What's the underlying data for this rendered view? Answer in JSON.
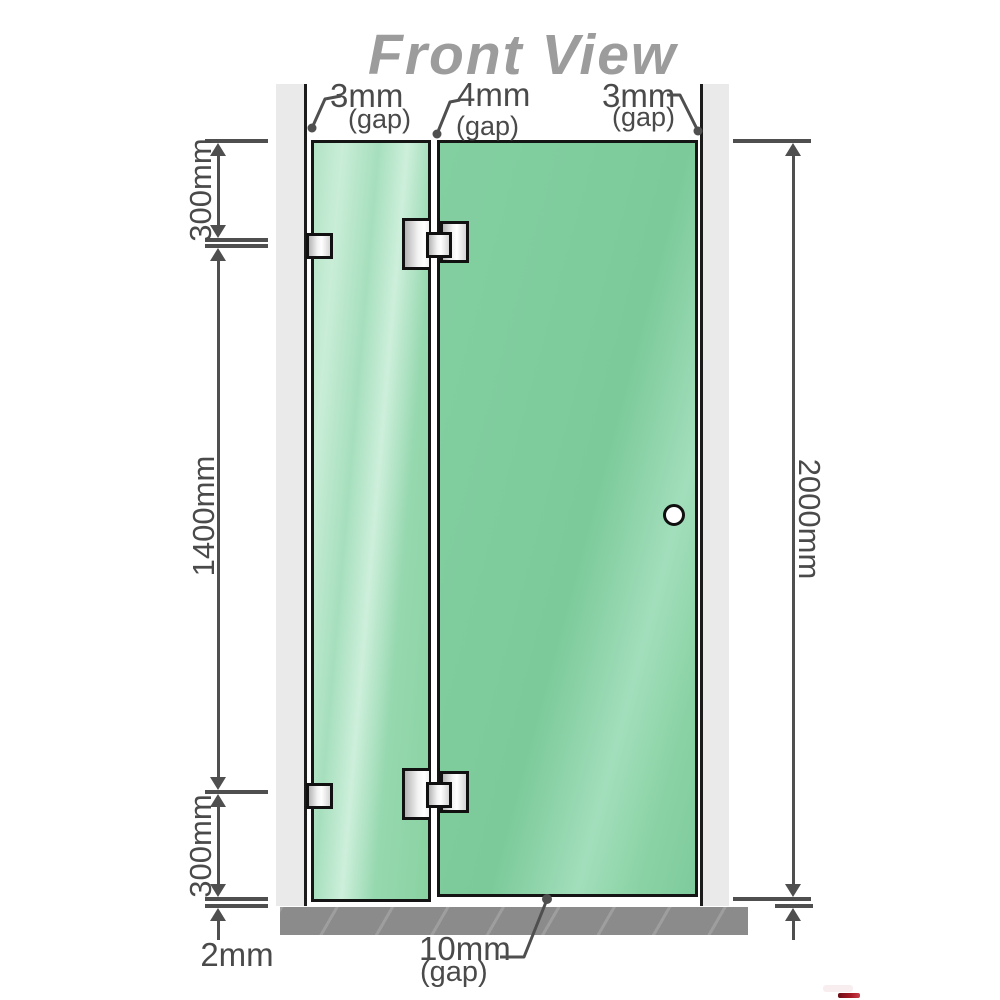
{
  "title": "Front View",
  "dimension_labels": {
    "top_left_gap": {
      "value": "3mm",
      "note": "(gap)"
    },
    "top_middle_gap": {
      "value": "4mm",
      "note": "(gap)"
    },
    "top_right_gap": {
      "value": "3mm",
      "note": "(gap)"
    },
    "left_upper": "300mm",
    "left_middle": "1400mm",
    "left_lower": "300mm",
    "bottom_left": "2mm",
    "right_full_height": "2000mm",
    "bottom_gap": {
      "value": "10mm",
      "note": "(gap)"
    }
  },
  "colors": {
    "glass_green": "#7fcc9e",
    "glass_highlight": "#cdefdb",
    "wall_gray": "#eaeaea",
    "floor_gray": "#8b8b8b",
    "dimension_gray": "#4f4f4f",
    "title_gray": "#9c9c9c",
    "logo_red": "#a91a25"
  }
}
